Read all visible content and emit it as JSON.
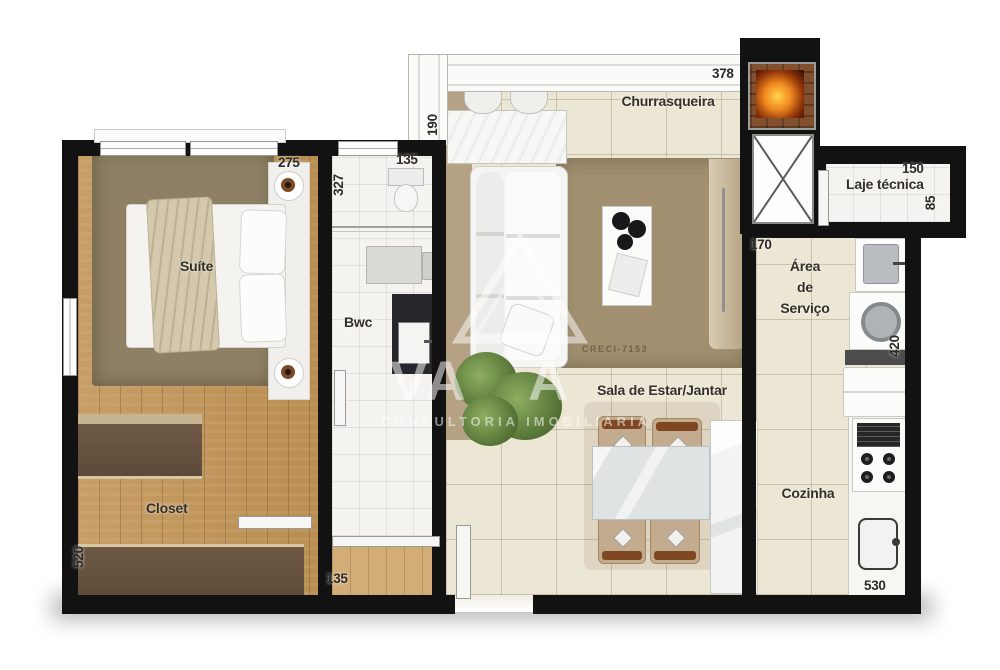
{
  "plan": {
    "rooms": {
      "suite": "Suíte",
      "bwc": "Bwc",
      "closet": "Closet",
      "churrasqueira": "Churrasqueira",
      "laje_tecnica": "Laje técnica",
      "servico_l1": "Área",
      "servico_l2": "de",
      "servico_l3": "Serviço",
      "sala": "Sala de Estar/Jantar",
      "cozinha": "Cozinha"
    },
    "dims": {
      "suite_width": "275",
      "bwc_depth": "327",
      "bwc_width": "135",
      "balcony_depth": "190",
      "sala_width": "378",
      "laje_width": "150",
      "laje_depth": "85",
      "servico_width": "170",
      "servico_depth": "420",
      "closet_depth": "520",
      "hall_width": "135",
      "cozinha_depth": "530"
    },
    "watermark": {
      "word_start": "VA",
      "word_end": "A",
      "subtitle": "CONSULTORIA IMOBILIÁRIA",
      "creci": "CRECI-7153"
    },
    "colors": {
      "wall": "#121212",
      "floor_tile": "#ece6d4",
      "floor_wood": "#c49a61",
      "rug": "#a29071",
      "fire_accent": "#f08a1f"
    }
  }
}
